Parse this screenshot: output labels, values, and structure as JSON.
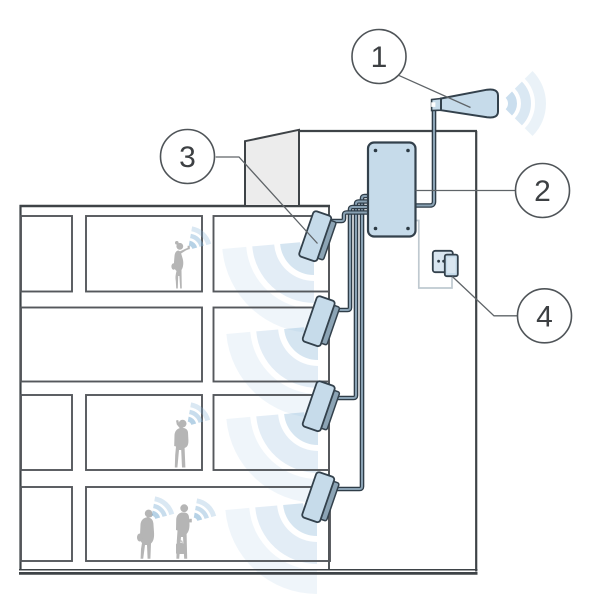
{
  "diagram": {
    "title": "in-building-cellular-signal-booster-system",
    "callouts": [
      {
        "number": "1",
        "label": "outdoor-donor-antenna"
      },
      {
        "number": "2",
        "label": "signal-booster-unit"
      },
      {
        "number": "3",
        "label": "indoor-panel-antenna"
      },
      {
        "number": "4",
        "label": "power-outlet-plug"
      }
    ],
    "counts": {
      "floors": 4,
      "indoor_antennas": 4,
      "people": 4
    },
    "colors": {
      "device_fill": "#c6dbea",
      "device_stroke": "#33414c",
      "signal_blue": "#96bedd",
      "structure_line": "#3e4347",
      "people_gray": "#b5b5b5",
      "penthouse_fill": "#ececec",
      "power_cord": "#bfc9d0"
    }
  }
}
